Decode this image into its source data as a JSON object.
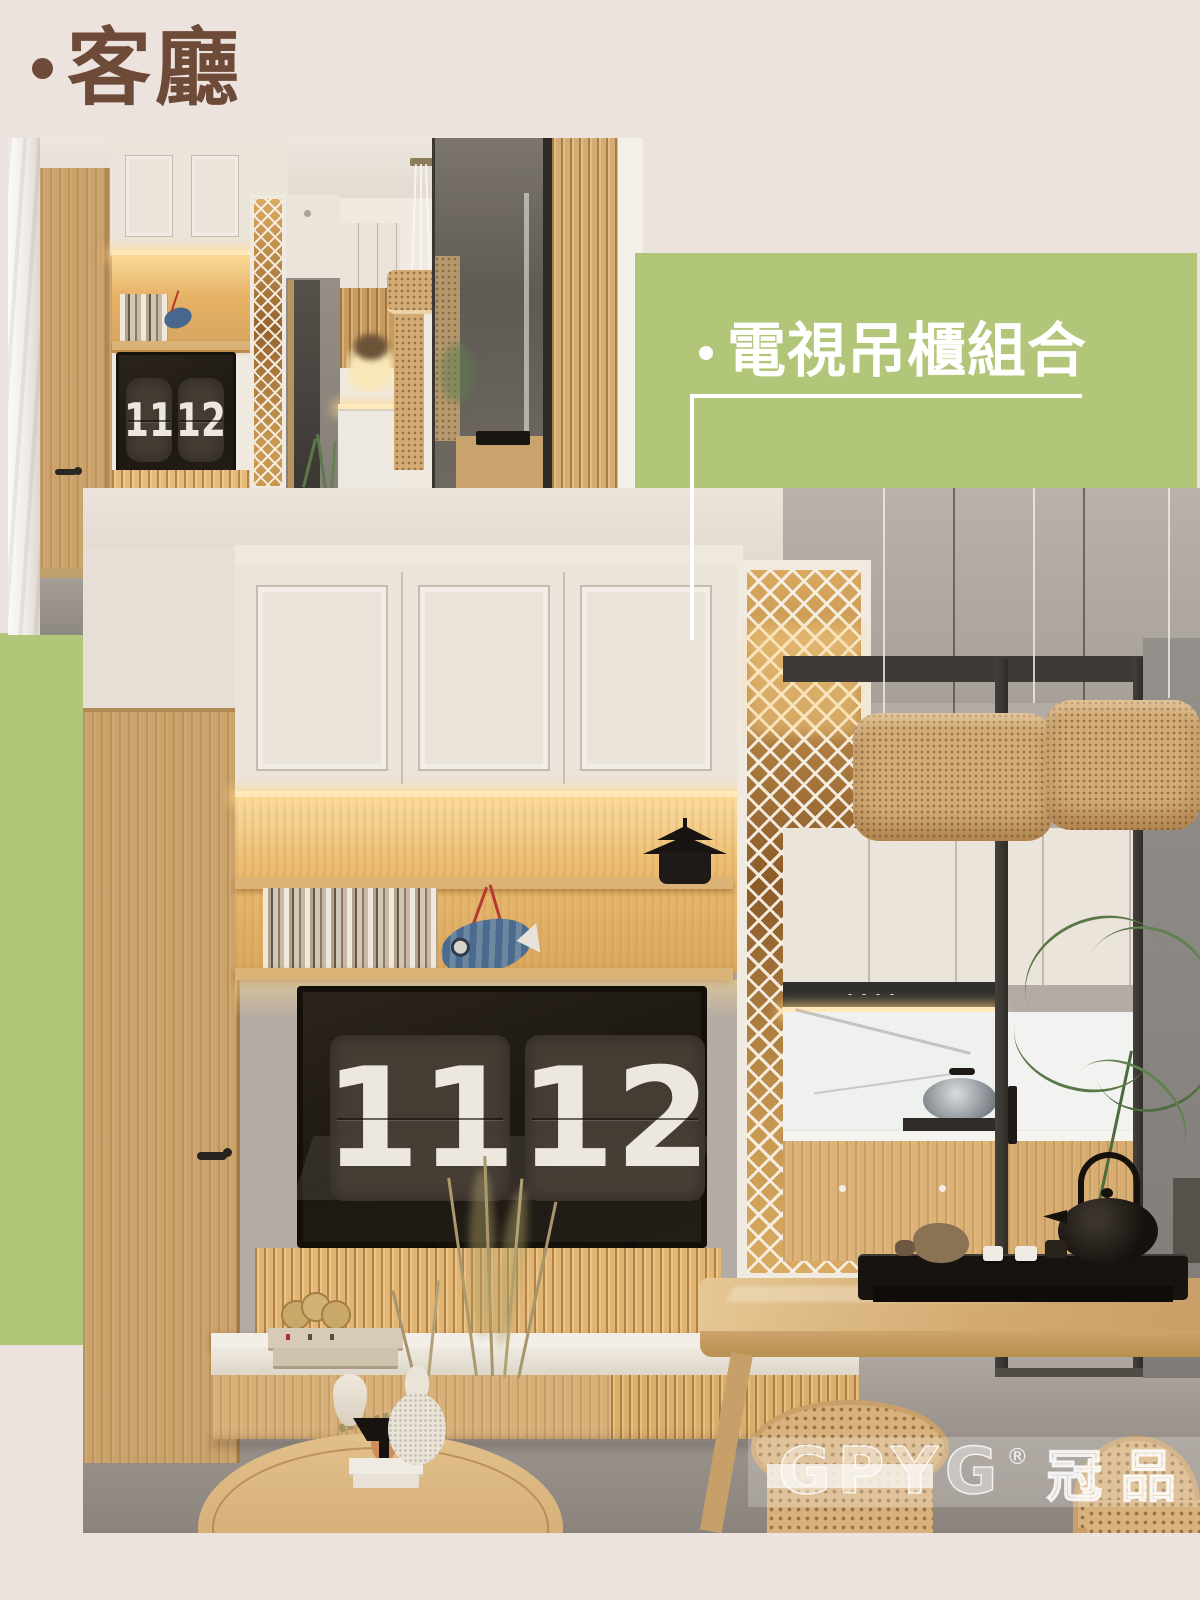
{
  "title": {
    "bullet": "·",
    "text": "客廳"
  },
  "label": {
    "bullet": "·",
    "text": "電視吊櫃組合"
  },
  "clock": {
    "left": "11",
    "right": "12"
  },
  "watermark": {
    "brand": "GPYG",
    "reg": "®",
    "cjk": "冠品"
  },
  "colors": {
    "bg": "#ede3de",
    "green": "#b2c67a",
    "brown": "#6e4a39",
    "line": "#ffffff",
    "cabinet": "#ebe4da",
    "glow": "#f6cf8e",
    "digit": "#ece7df"
  }
}
